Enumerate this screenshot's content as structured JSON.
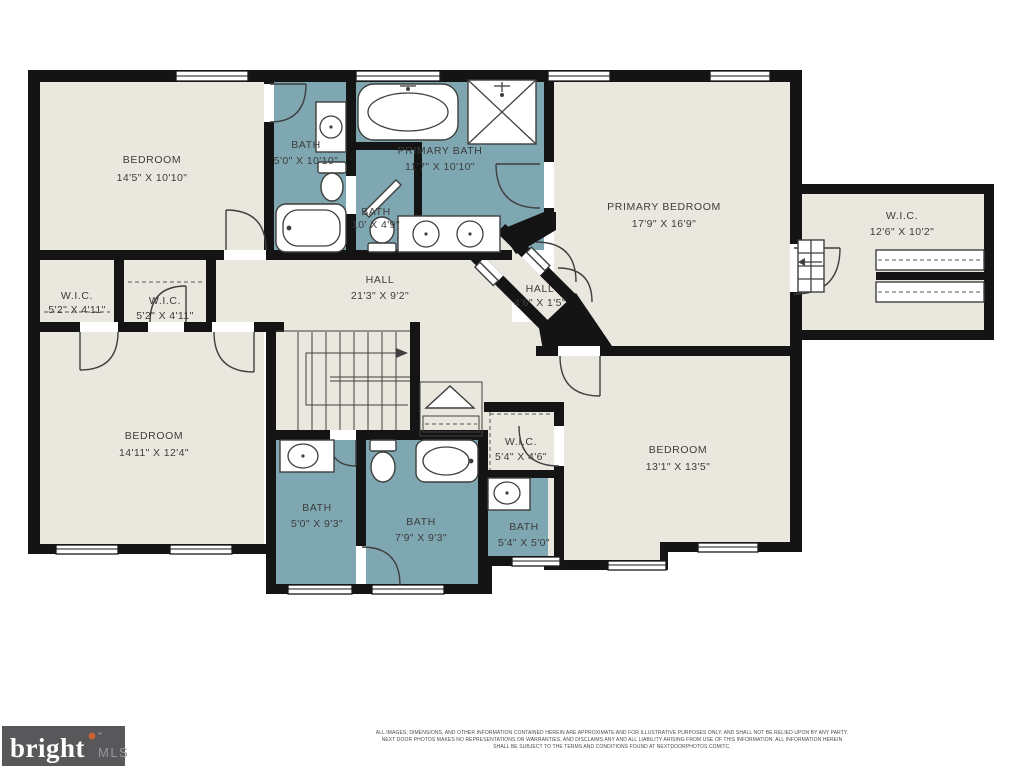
{
  "colors": {
    "floor": "#e9e7de",
    "bath": "#7ea7b1",
    "wall": "#141414",
    "line": "#3f3f3f",
    "label": "#3d3d3d",
    "logo_bg": "#58585b",
    "logo_text": "#ffffff",
    "logo_mls": "#98989a",
    "logo_dot": "#c9622f"
  },
  "rooms": {
    "bedroom_tl": {
      "name": "BEDROOM",
      "dims": "14'5\" X 10'10\""
    },
    "bath_tl": {
      "name": "BATH",
      "dims": "5'0\" X 10'10\""
    },
    "bath_mid": {
      "name": "BATH",
      "dims": "10' X 4'9\""
    },
    "primary_bath": {
      "name": "PRIMARY BATH",
      "dims": "11'7\" X 10'10\""
    },
    "primary_bedroom": {
      "name": "PRIMARY BEDROOM",
      "dims": "17'9\" X 16'9\""
    },
    "wic_right": {
      "name": "W.I.C.",
      "dims": "12'6\" X 10'2\""
    },
    "wic_left1": {
      "name": "W.I.C.",
      "dims": "5'2\" X 4'11\""
    },
    "wic_left2": {
      "name": "W.I.C.",
      "dims": "5'2\" X 4'11\""
    },
    "hall_main": {
      "name": "HALL",
      "dims": "21'3\" X 9'2\""
    },
    "hall_small": {
      "name": "HALL",
      "dims": "4'6\" X 1'5\""
    },
    "bedroom_bl": {
      "name": "BEDROOM",
      "dims": "14'11\" X 12'4\""
    },
    "bath_b1": {
      "name": "BATH",
      "dims": "5'0\" X 9'3\""
    },
    "bath_b2": {
      "name": "BATH",
      "dims": "7'9\" X 9'3\""
    },
    "bath_b3": {
      "name": "BATH",
      "dims": "5'4\" X 5'0\""
    },
    "wic_small": {
      "name": "W.I.C.",
      "dims": "5'4\" X 4'6\""
    },
    "bedroom_br": {
      "name": "BEDROOM",
      "dims": "13'1\" X 13'5\""
    }
  },
  "footer": {
    "line1": "ALL IMAGES, DIMENSIONS, AND OTHER INFORMATION CONTAINED HEREIN ARE APPROXIMATE AND FOR ILLUSTRATIVE PURPOSES ONLY, AND SHALL NOT BE RELIED UPON BY ANY PARTY.",
    "line2": "NEXT DOOR PHOTOS MAKES NO REPRESENTATIONS OR WARRANTIES, AND DISCLAIMS ANY AND ALL LIABILITY ARISING FROM USE OF THIS INFORMATION. ALL INFORMATION HEREIN",
    "line3": "SHALL BE SUBJECT TO THE TERMS AND CONDITIONS FOUND AT NEXTDOORPHOTOS.COM/TC."
  },
  "logo": {
    "brand": "bright",
    "suffix": "MLS",
    "tm": "™"
  }
}
